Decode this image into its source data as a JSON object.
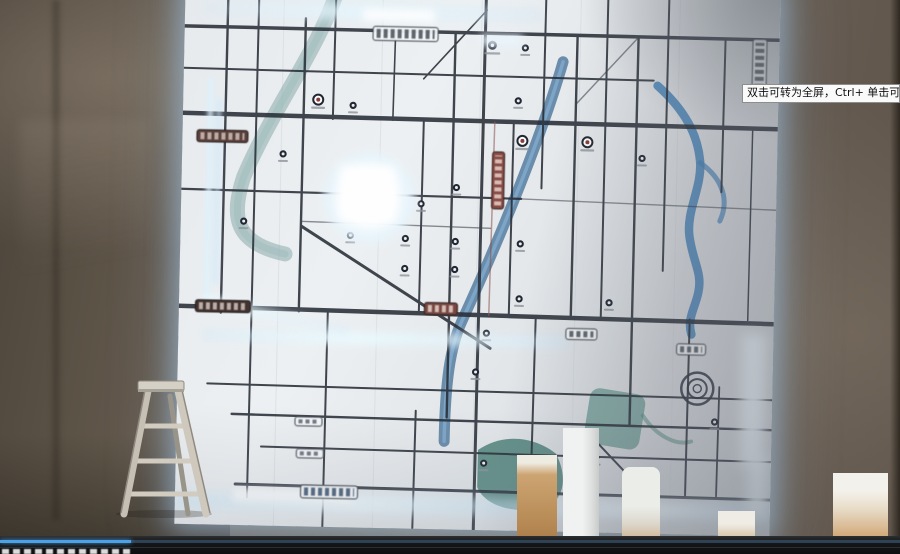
{
  "tooltip": {
    "text": "双击可转为全屏，Ctrl+ 单击可转为"
  },
  "player": {
    "progress_style": "width:131px"
  },
  "colors": {
    "accent_blue": "#4aa3e8",
    "map_glow": "#cfe9ff",
    "wall": "#6b6052",
    "map_background": "#e9edf0",
    "road": "#262c36",
    "river_blue": "#49759c",
    "river_teal": "#7fa6a6"
  }
}
